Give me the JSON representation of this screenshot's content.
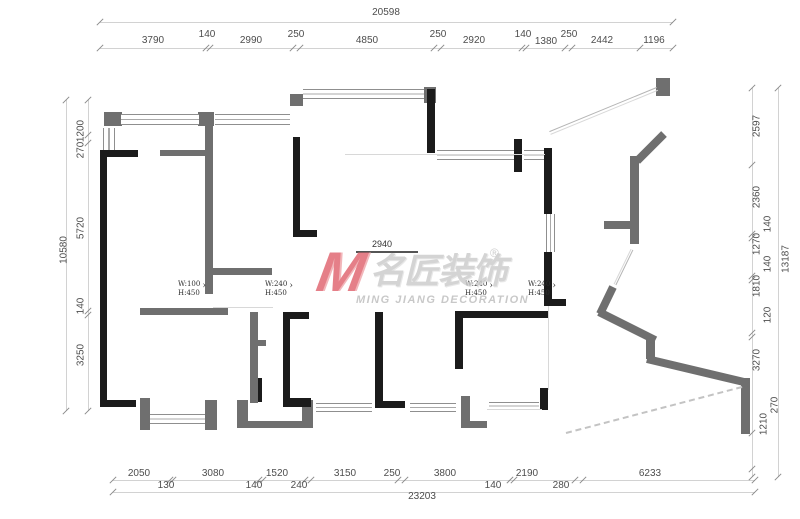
{
  "dims": {
    "top_total": "20598",
    "top": [
      "3790",
      "140",
      "2990",
      "250",
      "4850",
      "250",
      "2920",
      "140",
      "1380",
      "250",
      "2442",
      "1196"
    ],
    "left_total": "10580",
    "left": [
      "1200",
      "270",
      "5720",
      "140",
      "3250"
    ],
    "right_total": "13187",
    "right": [
      "2597",
      "2360",
      "140",
      "1270",
      "140",
      "1810",
      "120",
      "3270",
      "1210",
      "270"
    ],
    "bottom_total": "23203",
    "bottom": [
      "2050",
      "130",
      "3080",
      "140",
      "1520",
      "240",
      "3150",
      "250",
      "3800",
      "140",
      "2190",
      "280",
      "6233"
    ]
  },
  "annotations": [
    {
      "w": "W:100",
      "h": "H:450",
      "arrow": "›"
    },
    {
      "w": "W:240",
      "h": "H:450",
      "arrow": "›"
    },
    {
      "w": "W:240",
      "h": "H:450",
      "arrow": "›"
    },
    {
      "w": "W:240",
      "h": "H:450",
      "arrow": "›"
    }
  ],
  "opening_dim": "2940",
  "watermark": {
    "logo": "M",
    "brand": "名匠装饰",
    "registered": "®",
    "subtitle": "MING JIANG DECORATION"
  },
  "colors": {
    "wall_black": "#1b1b1b",
    "wall_gray": "#6f6f6f",
    "dim_text": "#4d4d4d",
    "watermark_red": "#e0646f",
    "watermark_gray": "#cbcbcb"
  }
}
